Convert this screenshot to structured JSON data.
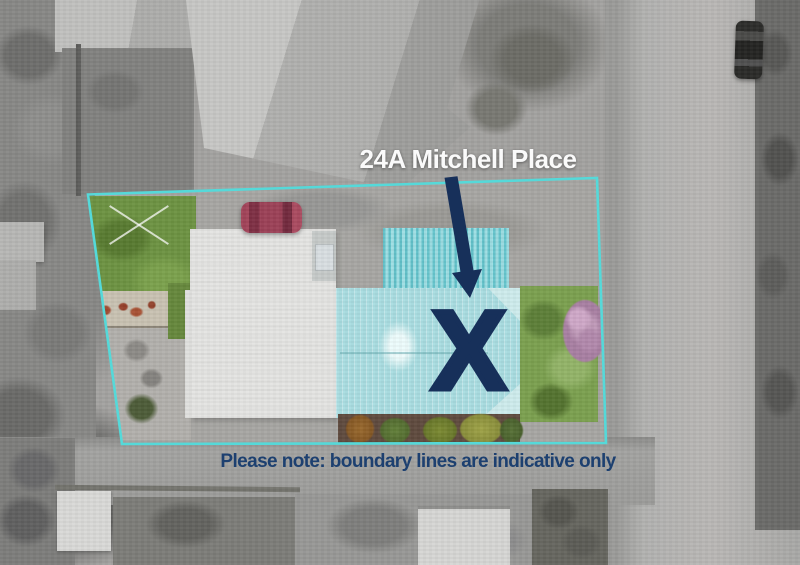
{
  "title": {
    "text": "24A Mitchell Place"
  },
  "marker": {
    "glyph": "X"
  },
  "note": {
    "text": "Please note: boundary lines are indicative only"
  },
  "colors": {
    "boundary_cyan": "#55d9d9",
    "marker_navy": "#17305a",
    "note_navy": "#1d4070",
    "title_white": "#fafafa",
    "roof_teal": "#a9dde1",
    "lawn_green": "#6d9342",
    "car_red": "#a2445a"
  }
}
